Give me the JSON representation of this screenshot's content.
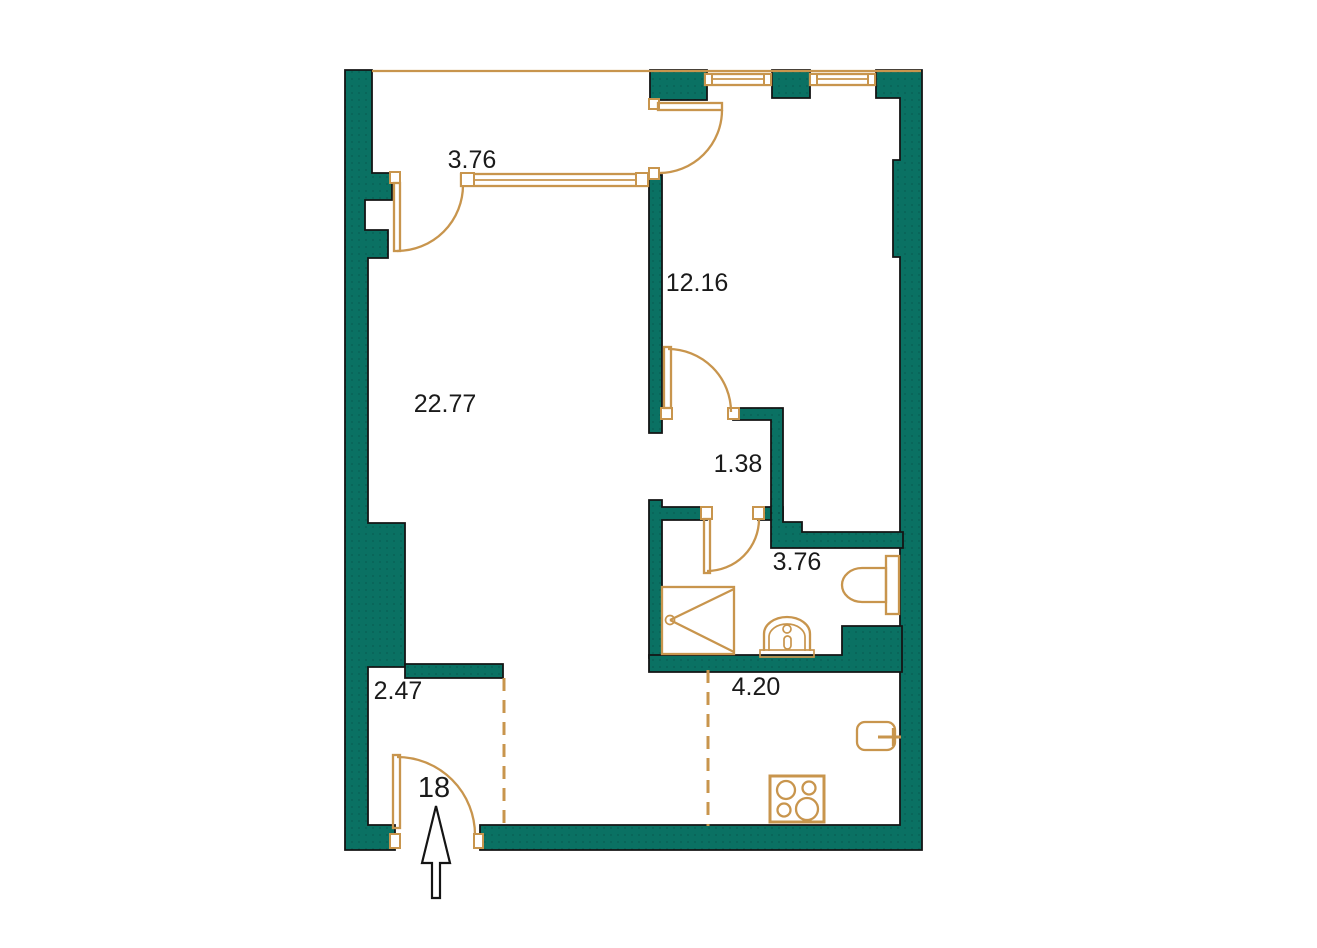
{
  "plan": {
    "apartment_number": "18",
    "rooms": {
      "loggia": {
        "label": "3.76"
      },
      "bedroom": {
        "label": "12.16"
      },
      "living": {
        "label": "22.77"
      },
      "hall": {
        "label": "1.38"
      },
      "bathroom": {
        "label": "3.76"
      },
      "entry": {
        "label": "2.47"
      },
      "kitchen": {
        "label": "4.20"
      }
    }
  },
  "colors": {
    "wall": "#0A7163",
    "fixture": "#C8954D",
    "outline": "#141414",
    "text": "#1A1A1A",
    "arrow_fill": "#FFFFFF",
    "background": "#FFFFFF"
  }
}
